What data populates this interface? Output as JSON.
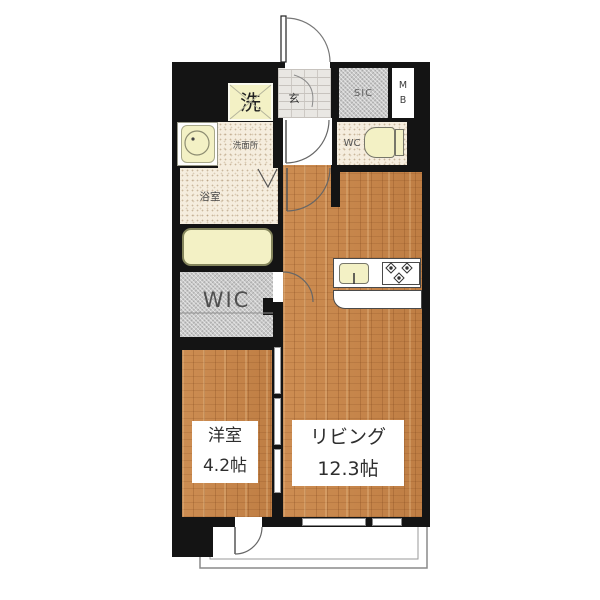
{
  "plan": {
    "rooms": {
      "laundry": {
        "label": "洗"
      },
      "entrance": {
        "label": "玄"
      },
      "shoe_closet": {
        "label": "SIC"
      },
      "meter_box": {
        "top": "M",
        "bottom": "B"
      },
      "washroom": {
        "label": "洗面所"
      },
      "toilet": {
        "label": "WC"
      },
      "bathroom": {
        "label": "浴室"
      },
      "walk_in_closet": {
        "label": "WIC"
      },
      "western_room": {
        "label": "洋室",
        "area": "4.2帖"
      },
      "living": {
        "label": "リビング",
        "area": "12.3帖"
      }
    },
    "colors": {
      "wall": "#141414",
      "wood_floor": "#c8874d",
      "fixture_yellow": "#f3f1c5",
      "tile_cream": "#f5edde",
      "closet_gray": "#c8c8c8",
      "background": "#ffffff"
    }
  }
}
